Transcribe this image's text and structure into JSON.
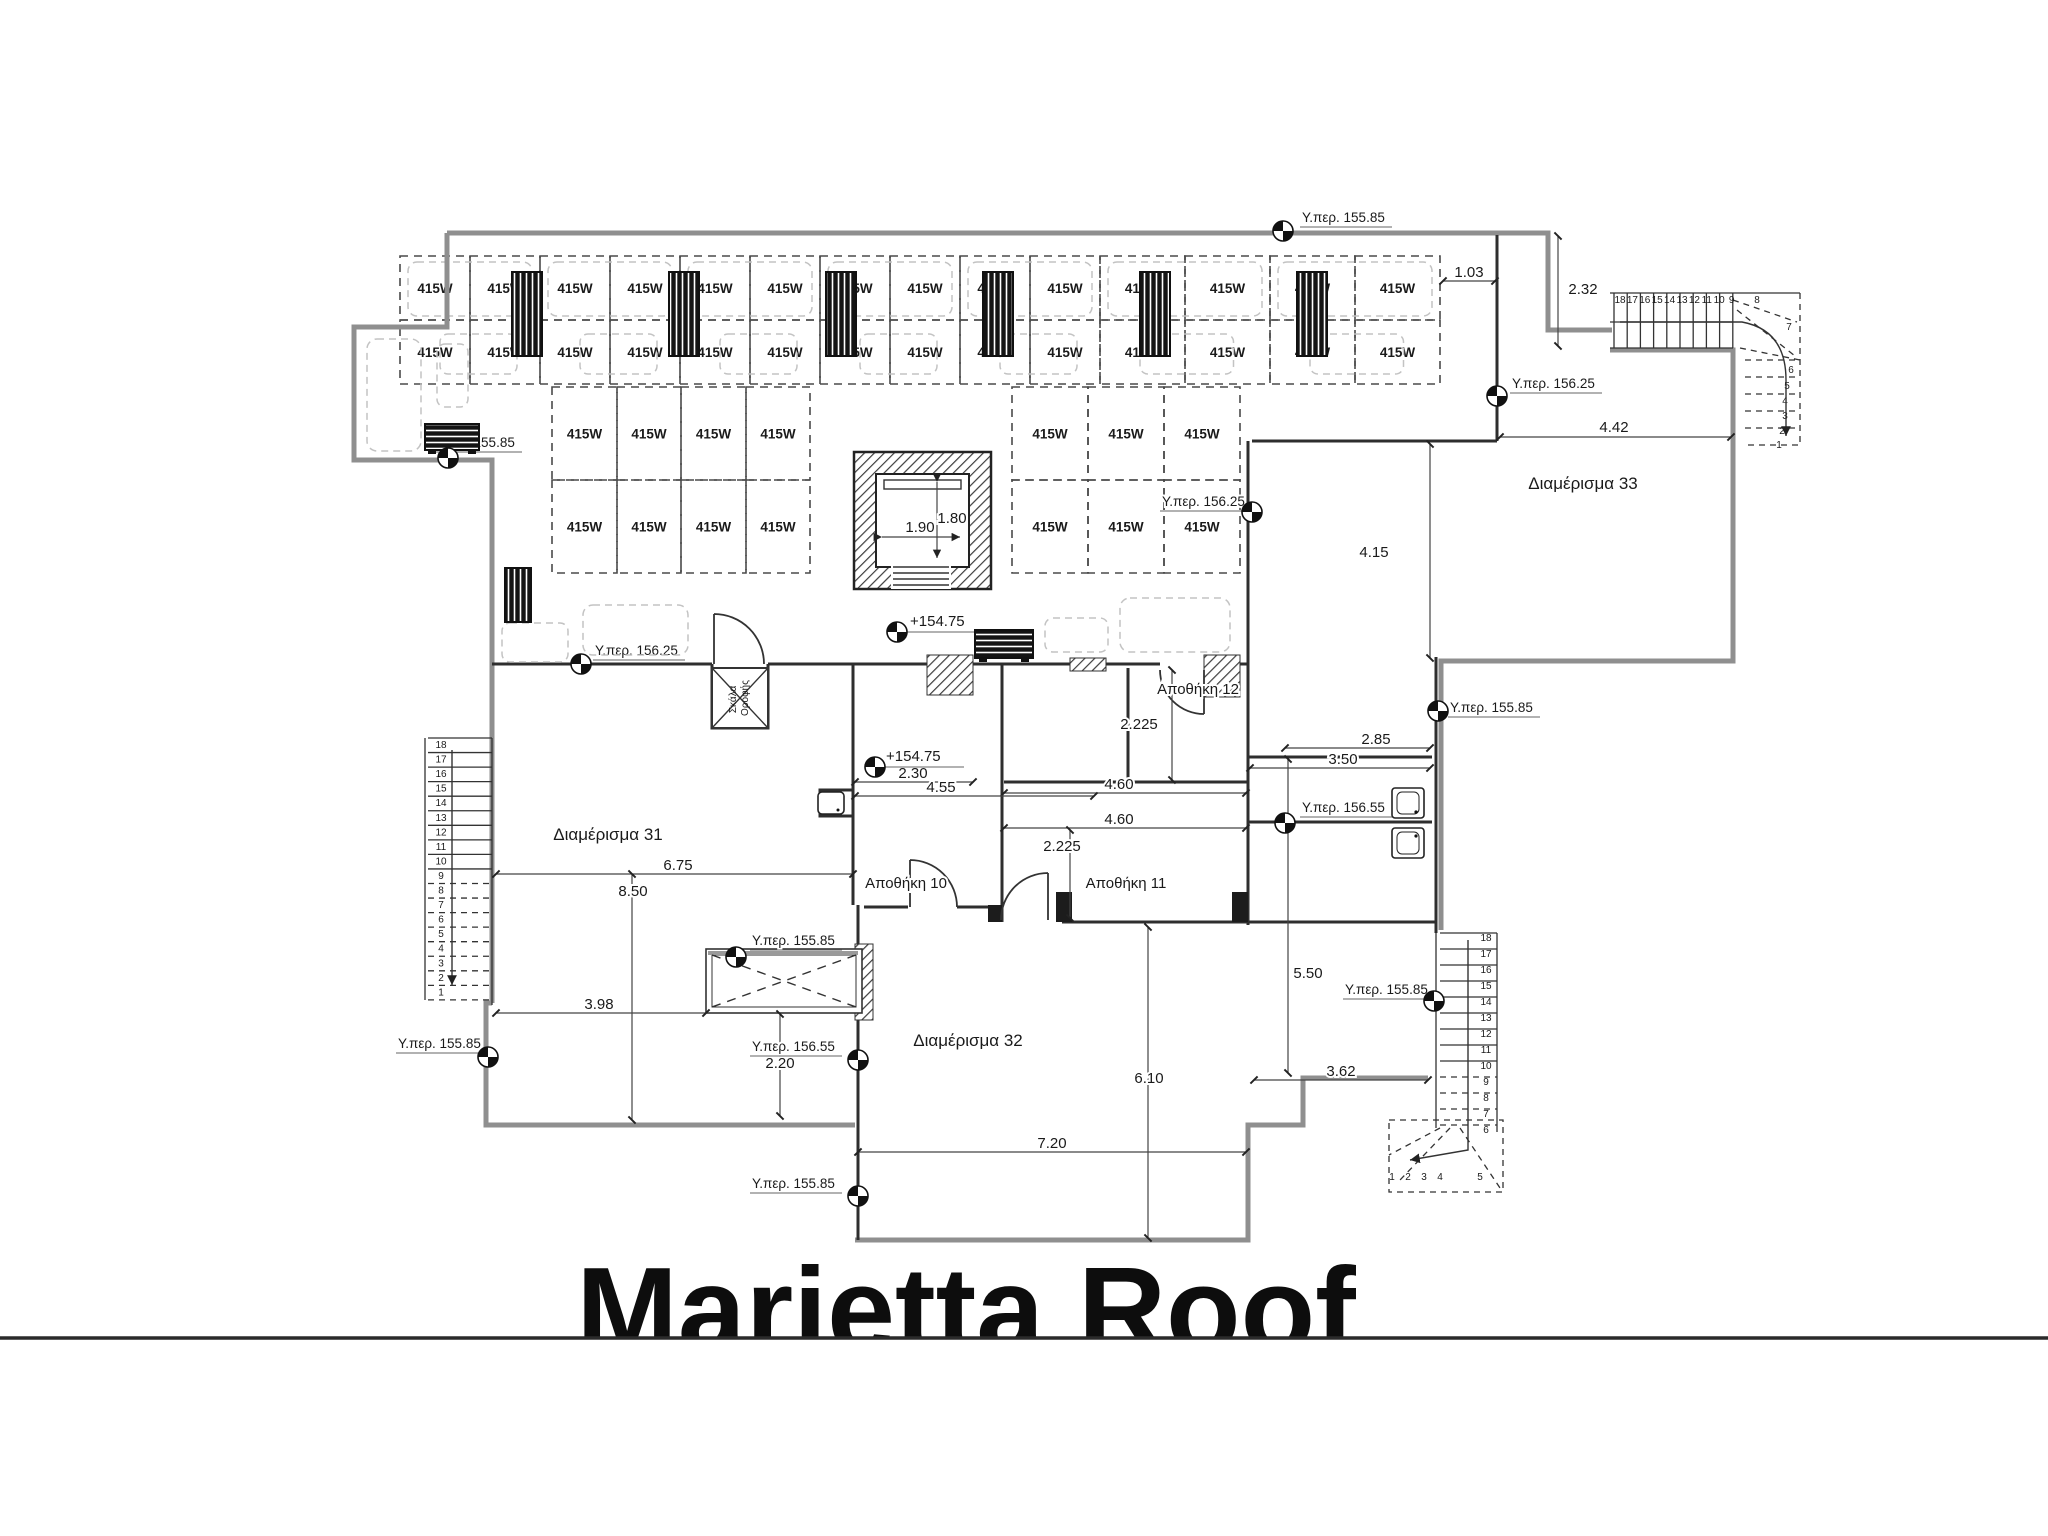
{
  "title": {
    "text": "Marietta Roof"
  },
  "solar": {
    "panel_label": "415W",
    "top_band": {
      "rows": 2,
      "cols": 14
    },
    "left_block": {
      "rows": 2,
      "cols": 4
    },
    "right_block": {
      "rows": 2,
      "cols": 3
    }
  },
  "levels": [
    {
      "id": "lv1",
      "text": "Υ.περ. 155.85"
    },
    {
      "id": "lv2",
      "text": "Υ.περ. 156.25"
    },
    {
      "id": "lv3",
      "text": "Υ.περ. 155.85"
    },
    {
      "id": "lv4",
      "text": "Υ.περ. 156.25"
    },
    {
      "id": "lv5",
      "text": "Υ.περ. 156.25"
    },
    {
      "id": "lv6",
      "text": "Υ.περ. 156.55"
    },
    {
      "id": "lv7",
      "text": "Υ.περ. 155.85"
    },
    {
      "id": "lv8",
      "text": "Υ.περ. 155.85"
    },
    {
      "id": "lv9",
      "text": "Υ.περ. 155.85"
    },
    {
      "id": "lv10",
      "text": "Υ.περ. 156.55"
    },
    {
      "id": "lv11",
      "text": "Υ.περ. 155.85"
    },
    {
      "id": "lv12",
      "text": "Υ.περ. 155.85"
    }
  ],
  "spot_levels": [
    "+154.75",
    "+154.75"
  ],
  "dimensions": [
    "1.03",
    "2.32",
    "4.42",
    "4.15",
    "1.80",
    "1.90",
    "2.225",
    "2.85",
    "3.50",
    "4.60",
    "4.60",
    "2.30",
    "4.55",
    "2.225",
    "6.75",
    "8.50",
    "3.98",
    "2.20",
    "5.50",
    "6.10",
    "3.62",
    "7.20"
  ],
  "rooms": [
    {
      "id": "r31",
      "name": "Διαμέρισμα 31"
    },
    {
      "id": "r32",
      "name": "Διαμέρισμα 32"
    },
    {
      "id": "r33",
      "name": "Διαμέρισμα 33"
    },
    {
      "id": "a10",
      "name": "Αποθήκη 10"
    },
    {
      "id": "a11",
      "name": "Αποθήκη 11"
    },
    {
      "id": "a12",
      "name": "Αποθήκη 12"
    }
  ],
  "roof_hatch": {
    "line1": "Σκάλα",
    "line2": "Οροφής"
  },
  "stairs": {
    "left_numbers": [
      "18",
      "17",
      "16",
      "15",
      "14",
      "13",
      "12",
      "11",
      "10",
      "9",
      "8",
      "7",
      "6",
      "5",
      "4",
      "3",
      "2",
      "1"
    ],
    "top_right_straight": [
      "18",
      "17",
      "16",
      "15",
      "14",
      "13",
      "12",
      "11",
      "10",
      "9"
    ],
    "top_right_winders": [
      "8",
      "7",
      "6",
      "5",
      "4",
      "3",
      "2",
      "1"
    ],
    "bottom_right_straight": [
      "18",
      "17",
      "16",
      "15",
      "14",
      "13",
      "12",
      "11",
      "10",
      "9",
      "8",
      "7",
      "6"
    ],
    "bottom_right_winders": [
      "1",
      "2",
      "3",
      "4",
      "5"
    ]
  },
  "colors": {
    "wall_gray": "#8f8f8f",
    "line_dark": "#2e2e2e",
    "paper": "#ffffff"
  }
}
